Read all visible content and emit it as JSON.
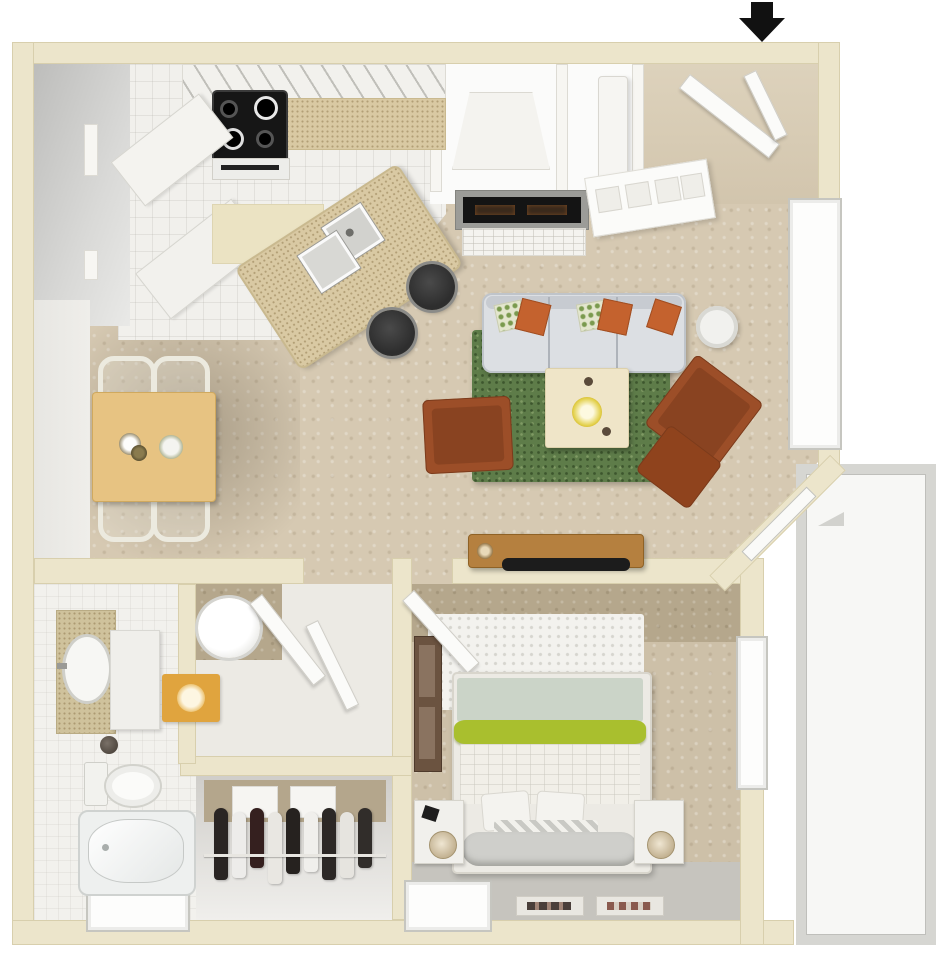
{
  "title": "one-bedroom-apartment-3d-floor-plan",
  "entrance": {
    "marker": "down-arrow-icon"
  },
  "colors": {
    "wall": "#ece5cb",
    "wall_edge": "#d8cfad",
    "floor_living": "#d6c9b2",
    "floor_kitchen": "#f1f0ec",
    "floor_bedroom": "#cdc0a8",
    "bedroom_wall_band": "#b5a78c",
    "floor_bath": "#f2f1ed",
    "patio_floor": "#f7f7f5",
    "patio_wall": "#d6d6d2",
    "rug_green": "#5e7c49",
    "sofa": "#dcdfe3",
    "pillow_orange": "#c4622e",
    "leather": "#9c4e28",
    "leather_dark": "#7a3b1c",
    "table_wood": "#e7c382",
    "console_wood": "#b5803f",
    "stove_black": "#161616",
    "stool_black": "#2e2e2e",
    "counter_speckle": "#d9c9a3",
    "bed_lime": "#a9bf2e",
    "bed_sage": "#cbd4c8",
    "mat_orange": "#e0a43e",
    "closet_back": "#b4a68c",
    "hall_gray": "#c7c7c5",
    "arrow_black": "#111111"
  },
  "rooms": [
    {
      "name": "kitchen",
      "furniture": [
        "stove",
        "upper-cabinets",
        "counter",
        "island-with-double-sink",
        "bar-stool",
        "bar-stool"
      ]
    },
    {
      "name": "dining-area",
      "furniture": [
        "dining-table",
        "chair",
        "chair",
        "chair",
        "chair"
      ]
    },
    {
      "name": "living-room",
      "furniture": [
        "sofa",
        "area-rug",
        "coffee-table",
        "armchair",
        "armchair",
        "ottoman",
        "side-table",
        "fireplace",
        "tv-console"
      ]
    },
    {
      "name": "entry",
      "furniture": [
        "entry-door",
        "hall-closet",
        "utility-column"
      ]
    },
    {
      "name": "bathroom",
      "furniture": [
        "vanity-sink",
        "cabinet",
        "washer",
        "toilet",
        "bathtub",
        "orange-mat",
        "window"
      ]
    },
    {
      "name": "closet",
      "furniture": [
        "hanging-clothes",
        "shelf-boxes",
        "closet-rod"
      ]
    },
    {
      "name": "bedroom",
      "furniture": [
        "queen-bed",
        "nightstand",
        "nightstand",
        "dresser",
        "fluffy-rug",
        "floor-mats",
        "window",
        "window"
      ]
    },
    {
      "name": "patio",
      "furniture": []
    }
  ],
  "closet": {
    "garments": [
      "#2a2523",
      "#edecea",
      "#35201f",
      "#e9e7e2",
      "#26221f",
      "#f0efec",
      "#2c2826",
      "#e6e4df",
      "#312d2a"
    ]
  },
  "bed": {
    "accent_stripe": "#a9bf2e"
  }
}
